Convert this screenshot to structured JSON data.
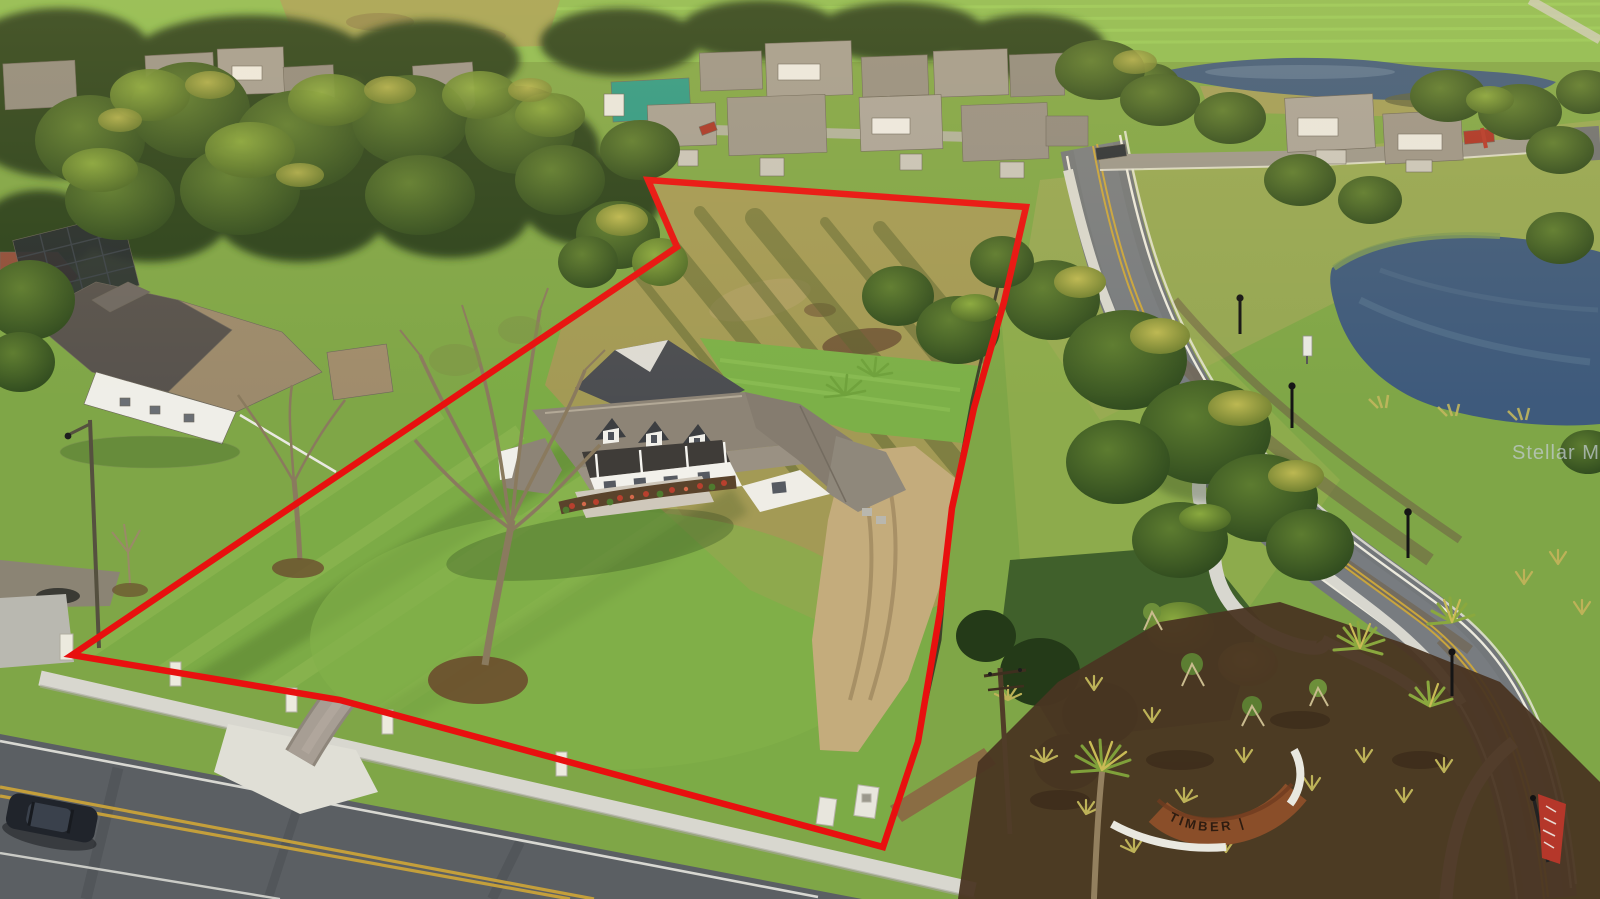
{
  "image": {
    "kind": "aerial drone real-estate photo",
    "subject": "large homesite with new modern farmhouse outlined in red, adjacent neighborhood, ponds and curving road",
    "width_px": 1600,
    "height_px": 899
  },
  "watermark": {
    "text": "Stellar MLS",
    "color": "#c3ccd3"
  },
  "boundary": {
    "color": "#e8100f",
    "stroke_width": 6.5,
    "points": "648,180 1026,207 1004,302 974,408 952,508 940,612 918,742 883,847 340,700 72,655 677,247"
  },
  "entrance_sign": {
    "label": "TIMBER |",
    "panel_color": "#8a4e29",
    "letter_color": "#2e1c10"
  },
  "banner_flag": {
    "color": "#b5372a"
  },
  "palette": {
    "grass_base": "#7fa647",
    "bright_field": "#8cbd52",
    "dry_field": "#a39a55",
    "lawn": "#7cab46",
    "asphalt_main": "#5b5f63",
    "asphalt_right": "#73777a",
    "concrete": "#d8d7cf",
    "pavers": "#a79e94",
    "pond_water": "#3e5a7c",
    "roof_gray": "#8d8476",
    "mulch": "#4a3522",
    "tree_dark": "#2c431d"
  }
}
